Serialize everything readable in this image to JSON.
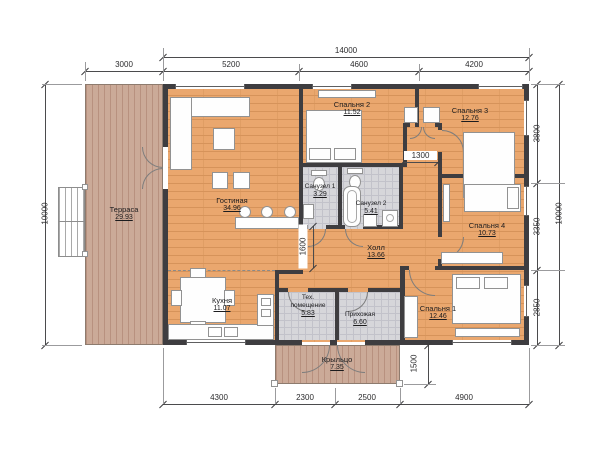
{
  "plan": {
    "title": "Планировка одноэтажного дома",
    "rooms": [
      {
        "name": "Терраса",
        "area": "29.93"
      },
      {
        "name": "Гостиная",
        "area": "34.96"
      },
      {
        "name": "Кухня",
        "area": "11.07"
      },
      {
        "name": "Санузел 1",
        "area": "3.29"
      },
      {
        "name": "Санузел 2",
        "area": "5.41"
      },
      {
        "name": "Спальня 2",
        "area": "11.52"
      },
      {
        "name": "Спальня 3",
        "area": "12.76"
      },
      {
        "name": "Спальня 4",
        "area": "10.73"
      },
      {
        "name": "Спальня 1",
        "area": "12.46"
      },
      {
        "name": "Холл",
        "area": "13.66"
      },
      {
        "name": "Тех. помещение",
        "area": "5.83"
      },
      {
        "name": "Прихожая",
        "area": "6.60"
      },
      {
        "name": "Крыльцо",
        "area": "7.35"
      }
    ],
    "dimensions": {
      "width_total": "14000",
      "top": [
        "3000",
        "5200",
        "4600",
        "4200"
      ],
      "left_total": "10000",
      "right": [
        "3800",
        "3350",
        "2850"
      ],
      "right_total": "10000",
      "bottom": [
        "4300",
        "2300",
        "2500",
        "4900"
      ],
      "porch_depth": "1500",
      "living_hall_opening": "1600",
      "corridor_width": "1300"
    },
    "colors": {
      "wall": "#3e3d40",
      "wood_floor": "#eaa76e",
      "wood_line": "#d6935a",
      "deck": "#cbaa98",
      "tile": "#d6d6da",
      "dimension": "#2c2c2e"
    }
  }
}
